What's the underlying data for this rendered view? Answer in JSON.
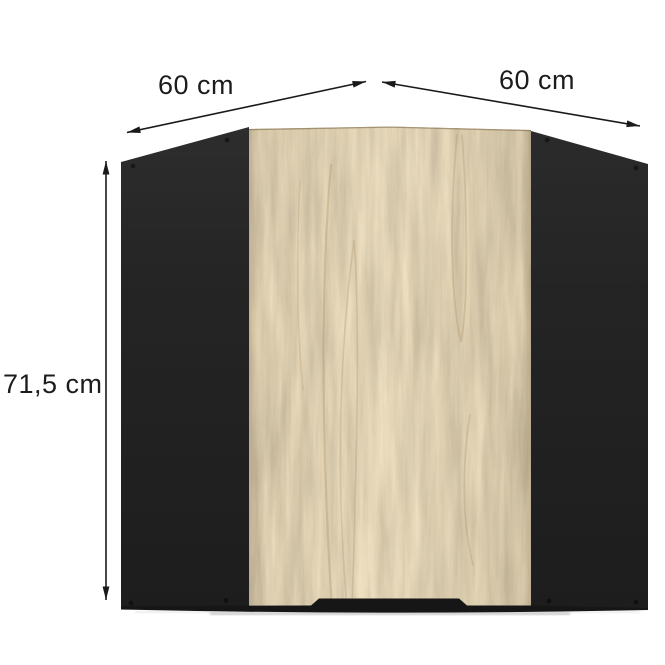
{
  "product": {
    "name": "corner wall cabinet",
    "view": "front dimension diagram",
    "front_material": "oak wood",
    "carcass_material": "black matte"
  },
  "dimensions": {
    "width_left": "60 cm",
    "width_right": "60 cm",
    "height": "71,5 cm"
  },
  "diagram": {
    "annotations": [
      {
        "label": "60 cm",
        "orientation": "diagonal-top-left",
        "arrow": "double-headed"
      },
      {
        "label": "60 cm",
        "orientation": "diagonal-top-right",
        "arrow": "double-headed"
      },
      {
        "label": "71,5 cm",
        "orientation": "vertical-left",
        "arrow": "double-headed"
      }
    ]
  },
  "colors": {
    "background": "#ffffff",
    "carcass_black": "#252525",
    "bottom_strip": "#161616",
    "oak_base": "#c6ae80",
    "oak_grain_dark": "#a3885c",
    "dimension_line": "#1a1a1a",
    "label_text": "#1c1c1c"
  }
}
